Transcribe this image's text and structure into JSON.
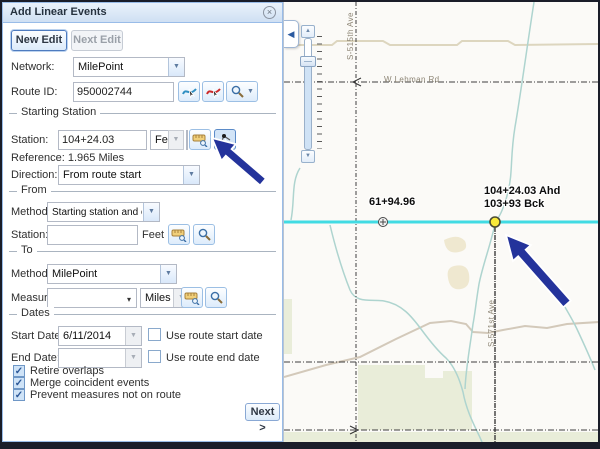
{
  "glyphs": {
    "close": "×",
    "dropdown": "▼",
    "combo_arrow": "▾",
    "up": "▲",
    "down": "▼",
    "collapse_left": "◀",
    "check": "✓"
  },
  "window": {
    "title": "Add Linear Events"
  },
  "toolbar": {
    "new_edit": "New Edit",
    "next_edit": "Next Edit"
  },
  "form": {
    "network": {
      "label": "Network:",
      "value": "MilePoint"
    },
    "route_id": {
      "label": "Route ID:",
      "value": "950002744"
    },
    "starting_station": {
      "legend": "Starting Station",
      "station": {
        "label": "Station:",
        "value": "104+24.03",
        "unit": "Feet"
      },
      "reference": "Reference: 1.965 Miles",
      "direction": {
        "label": "Direction:",
        "value": "From route start"
      }
    },
    "from": {
      "legend": "From",
      "method": {
        "label": "Method:",
        "value": "Starting station and offset"
      },
      "station": {
        "label": "Station:",
        "value": "",
        "unit": "Feet"
      }
    },
    "to": {
      "legend": "To",
      "method": {
        "label": "Method:",
        "value": "MilePoint"
      },
      "measure": {
        "label": "Measure:",
        "value": "",
        "unit": "Miles"
      }
    },
    "dates": {
      "legend": "Dates",
      "start": {
        "label": "Start Date:",
        "value": "6/11/2014",
        "checkbox_label": "Use route start date"
      },
      "end": {
        "label": "End Date:",
        "value": "",
        "checkbox_label": "Use route end date"
      }
    },
    "options": [
      {
        "label": "Retire overlaps",
        "checked": true
      },
      {
        "label": "Merge coincident events",
        "checked": true
      },
      {
        "label": "Prevent measures not on route",
        "checked": true
      }
    ],
    "next_button": "Next >"
  },
  "map": {
    "station_labels": {
      "left": "61+94.96",
      "ahead": "104+24.03 Ahd",
      "back": "103+93 Bck"
    },
    "roads": {
      "horizontal": "W Lehman Rd",
      "vertical_top": "S-515th Ave",
      "vertical_right": "S-571st Ave"
    },
    "colors": {
      "route_line": "#41dbe3",
      "marker_fill": "#f8e93a",
      "stream": "#aed4cf",
      "annotation_arrow": "#24339b"
    }
  }
}
